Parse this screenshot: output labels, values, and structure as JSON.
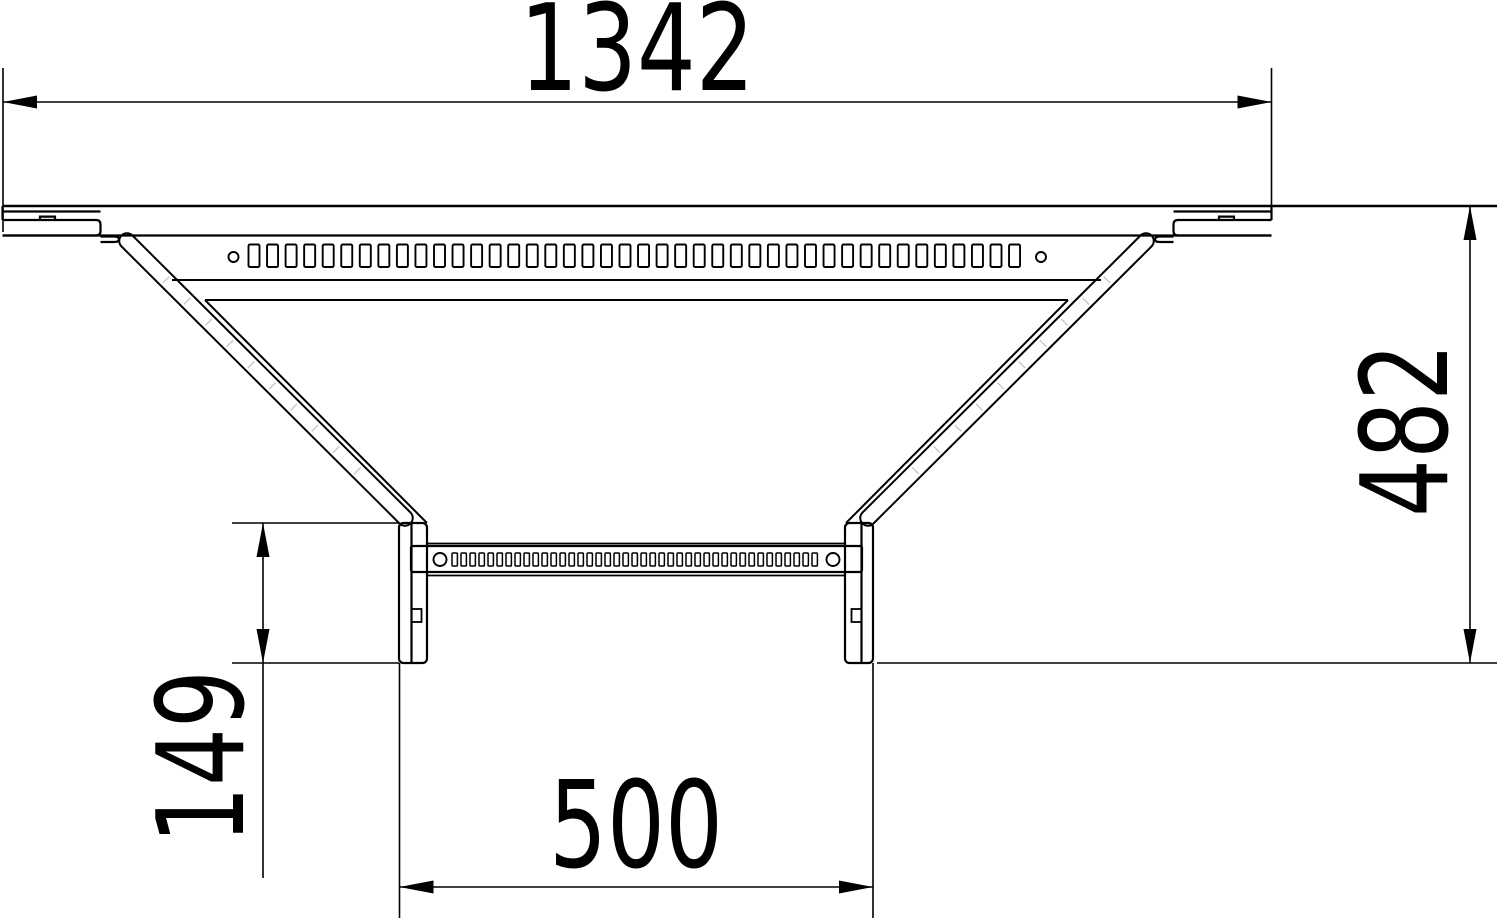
{
  "drawing": {
    "type": "technical-dimension-drawing",
    "subject": "Cable ladder add-on tee piece, top view",
    "units": "mm",
    "background_color": "#ffffff",
    "line_color": "#000000",
    "hatch_color": "#c4c4c4"
  },
  "dimensions": {
    "overall_width": {
      "label": "1342",
      "value": 1342
    },
    "overall_depth": {
      "label": "482",
      "value": 482
    },
    "branch_inset": {
      "label": "149",
      "value": 149
    },
    "branch_width": {
      "label": "500",
      "value": 500
    }
  },
  "perforations": {
    "main_strip": {
      "slot_count": 42,
      "start_x": 248.5,
      "pitch": 18.55,
      "slot_w": 11,
      "y": 244.5,
      "h": 22.5,
      "end_hole_r": 5,
      "hole_left_x": 233.5,
      "hole_right_x": 1041,
      "hole_y": 257
    },
    "branch_rung": {
      "slot_count": 41,
      "start_x": 452,
      "pitch": 9.0,
      "slot_w": 5.4,
      "y": 553,
      "h": 13,
      "end_hole_r": 6.5,
      "hole_left_x": 440,
      "hole_right_x": 833,
      "hole_y": 559.5
    }
  },
  "hatch_ticks": {
    "count_per_side": 10,
    "start_t": 55,
    "step_t": 30,
    "half_len": 4.6
  }
}
